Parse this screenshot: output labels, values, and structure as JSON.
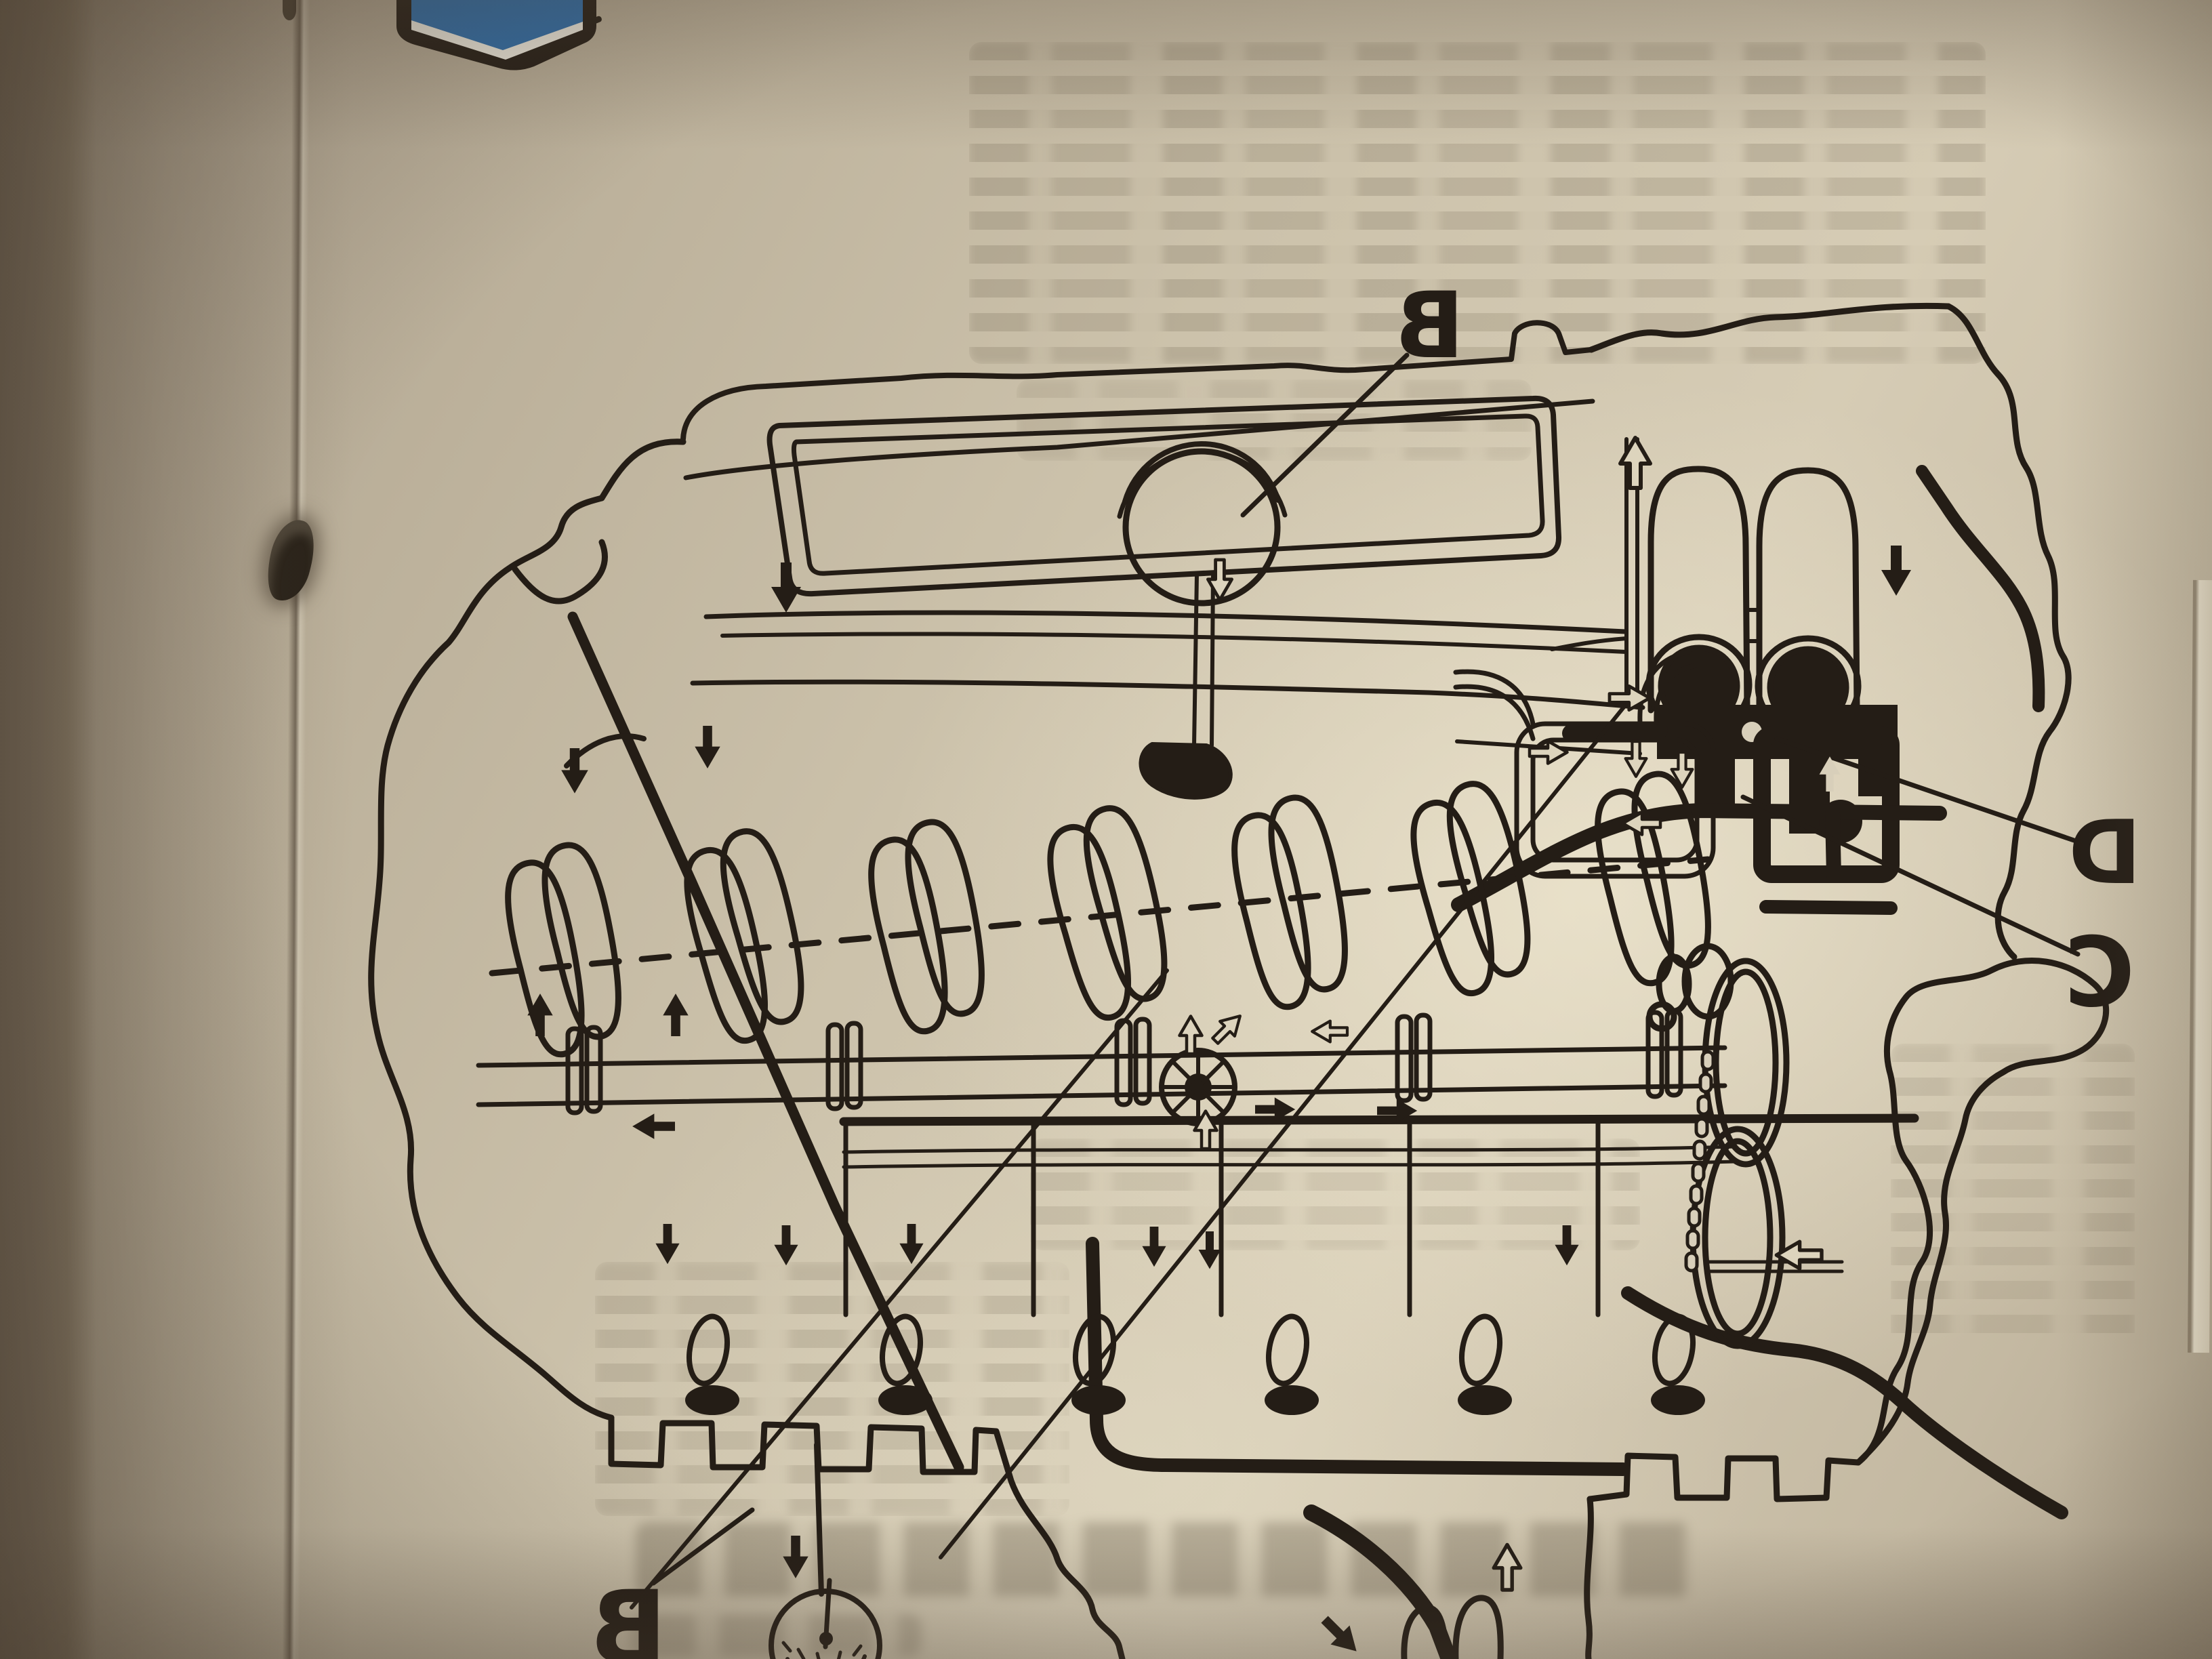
{
  "photo": {
    "description": "Photograph of a stapled manual page seen mirrored (printed diagram viewed through the back of the leaf): cutaway schematic of an engine lubrication system with oil-flow arrows",
    "callout_labels": {
      "top": "B",
      "right_upper": "D",
      "right_lower": "C",
      "bottom": "B"
    },
    "figure": {
      "orientation": "mirrored",
      "components": [
        "engine-block-silhouette",
        "valve-cover",
        "oil-filler-cap",
        "dipstick-tube",
        "twin-oil-filters",
        "oil-gallery-pipes",
        "crankshaft-counterweights",
        "camshaft",
        "oil-pump-drive-gear",
        "timing-chain",
        "flywheel-pulleys",
        "valve-tappets",
        "oil-sump",
        "oil-pickup-strainer",
        "solid-flow-arrows",
        "outline-flow-arrows"
      ]
    },
    "colors": {
      "paper_bright": "#e7dfc9",
      "paper_mid": "#c9bfa8",
      "paper_shadow": "#a79c89",
      "page_behind": "#a2988a",
      "book_edge_dark": "#5f5446",
      "ink": "#241d16",
      "blue_ink": "#2e6fae",
      "blue_ink_stripe": "#f2efe4",
      "bleed_text": "#8f8673"
    }
  }
}
